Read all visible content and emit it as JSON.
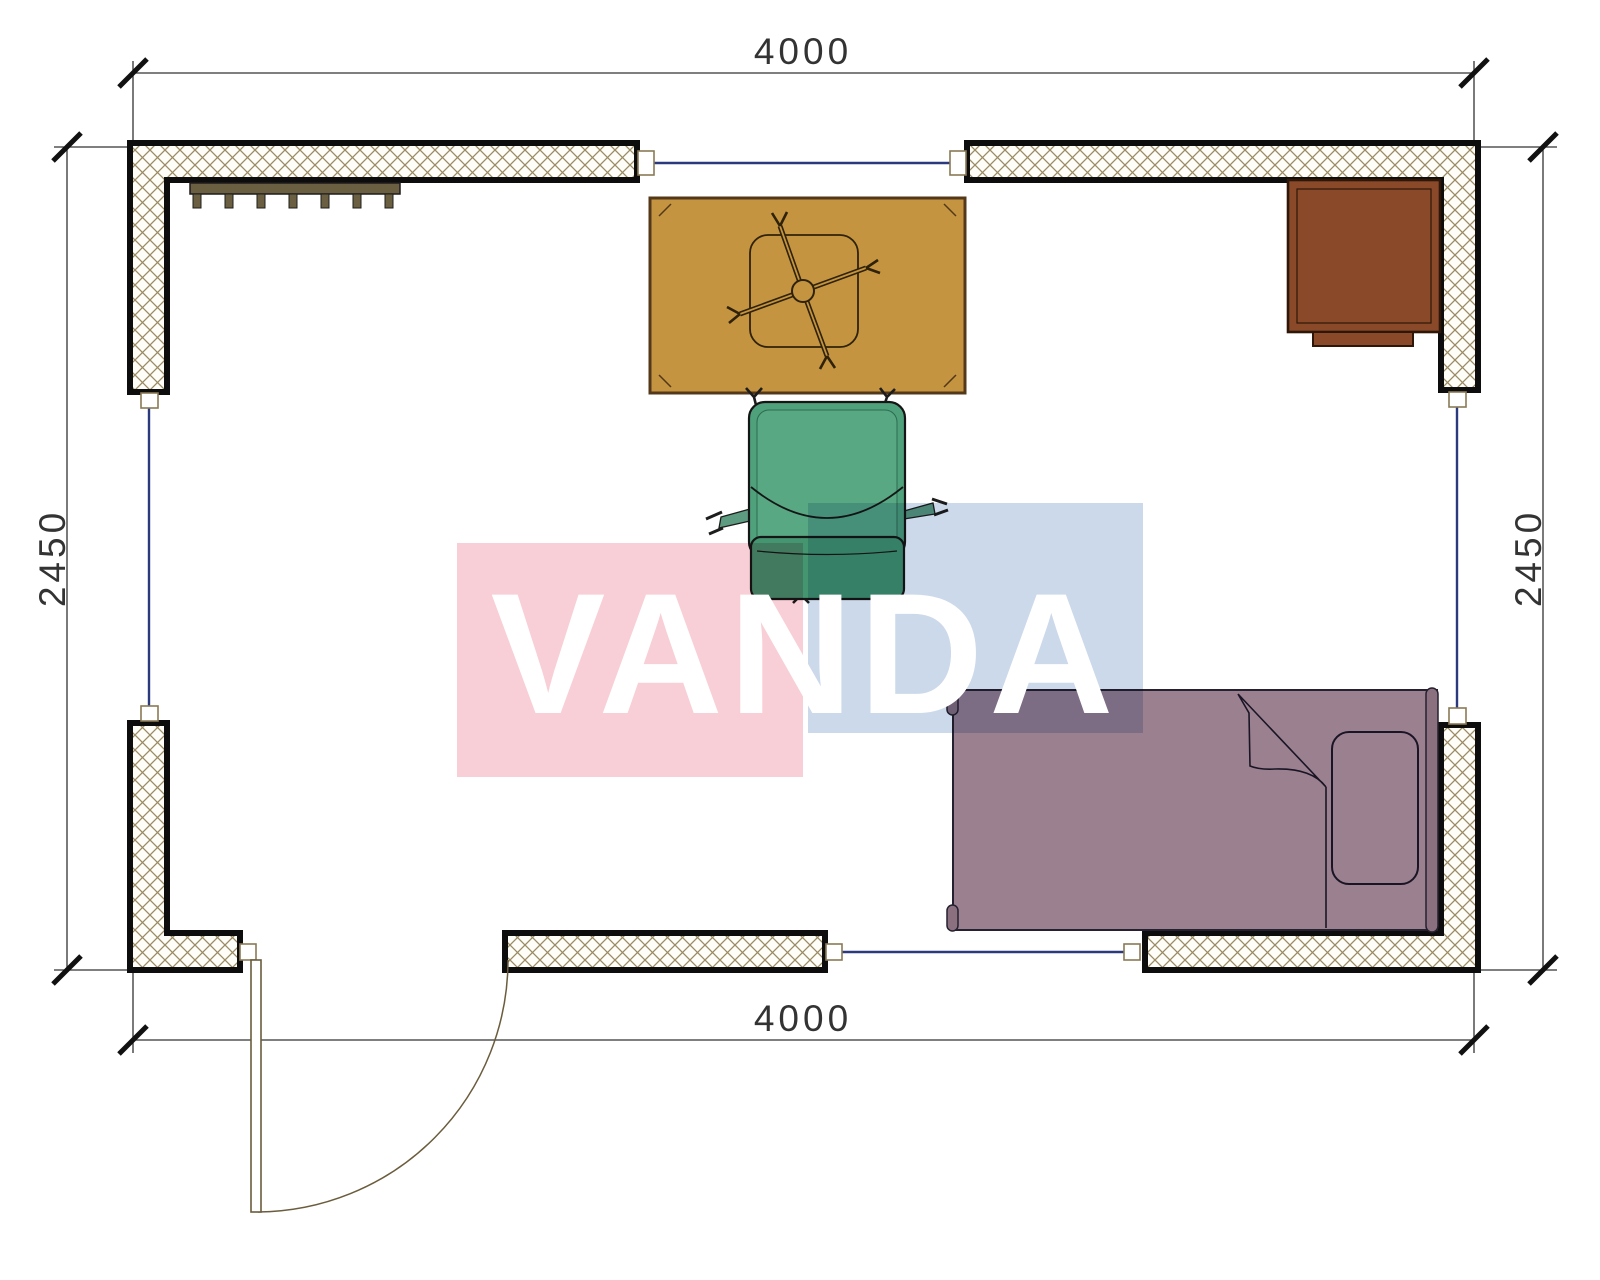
{
  "dimensions": {
    "top": "4000",
    "bottom": "4000",
    "left": "2450",
    "right": "2450"
  },
  "watermark": {
    "text": "VANDA",
    "pink": "#f8cfd6",
    "blue": "#ccd9ea",
    "letters": "#ffffff"
  },
  "plan": {
    "wall_hatch_line": "#9a8a64",
    "wall_outline": "#0d0d0d",
    "window_line": "#2b3a7e",
    "dimension_color": "#333333",
    "door_line": "#6a5c3c"
  },
  "furniture": {
    "radiator_color": "#6b5f41",
    "table_color": "#c49440",
    "office_chair_color": "#4fa17c",
    "office_chair_back_color": "#449671",
    "desk_color": "#8a4a2a",
    "bed_color": "#9b8090",
    "bed_accent_color": "#8b7080"
  }
}
